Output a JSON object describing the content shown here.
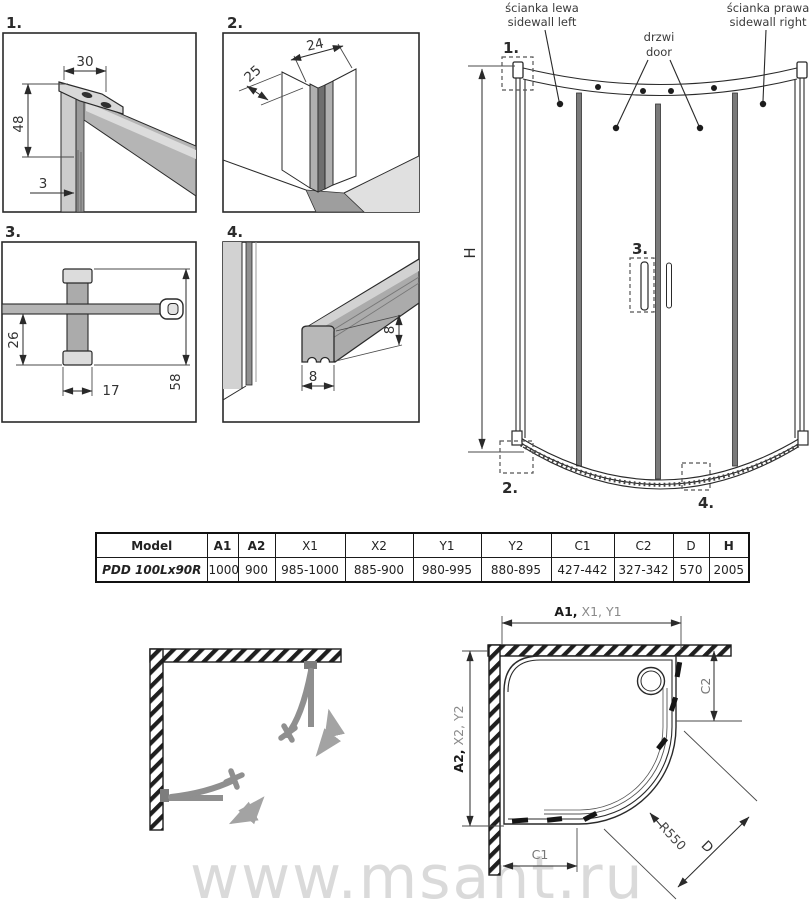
{
  "watermark": {
    "text": "www.msant.ru"
  },
  "details": {
    "d1": {
      "label": "1.",
      "dim_top_width": "30",
      "dim_height": "48",
      "dim_glass_thickness": "3"
    },
    "d2": {
      "label": "2.",
      "dim_depth": "25",
      "dim_profile_width": "24"
    },
    "d3": {
      "label": "3.",
      "dim_lower_offset": "26",
      "dim_bracket_width": "17",
      "dim_total_height": "58"
    },
    "d4": {
      "label": "4.",
      "dim_seal_height": "8",
      "dim_seal_width": "8"
    }
  },
  "elevation": {
    "labels": {
      "sidewall_left_pl": "ścianka lewa",
      "sidewall_left_en": "sidewall left",
      "door_pl": "drzwi",
      "door_en": "door",
      "sidewall_right_pl": "ścianka prawa",
      "sidewall_right_en": "sidewall right",
      "height": "H"
    },
    "callouts": {
      "c1": "1.",
      "c2": "2.",
      "c3": "3.",
      "c4": "4."
    }
  },
  "spec_table": {
    "headers": [
      "Model",
      "A1",
      "A2",
      "X1",
      "X2",
      "Y1",
      "Y2",
      "C1",
      "C2",
      "D",
      "H"
    ],
    "row": [
      "PDD 100Lx90R",
      "1000",
      "900",
      "985-1000",
      "885-900",
      "980-995",
      "880-895",
      "427-442",
      "327-342",
      "570",
      "2005"
    ]
  },
  "plan": {
    "dim_width_primary": "A1,",
    "dim_width_secondary": " X1, Y1",
    "dim_depth_primary": "A2,",
    "dim_depth_secondary": " X2, Y2",
    "dim_c1": "C1",
    "dim_c2": "C2",
    "dim_radius": "R550",
    "dim_door": "D"
  }
}
